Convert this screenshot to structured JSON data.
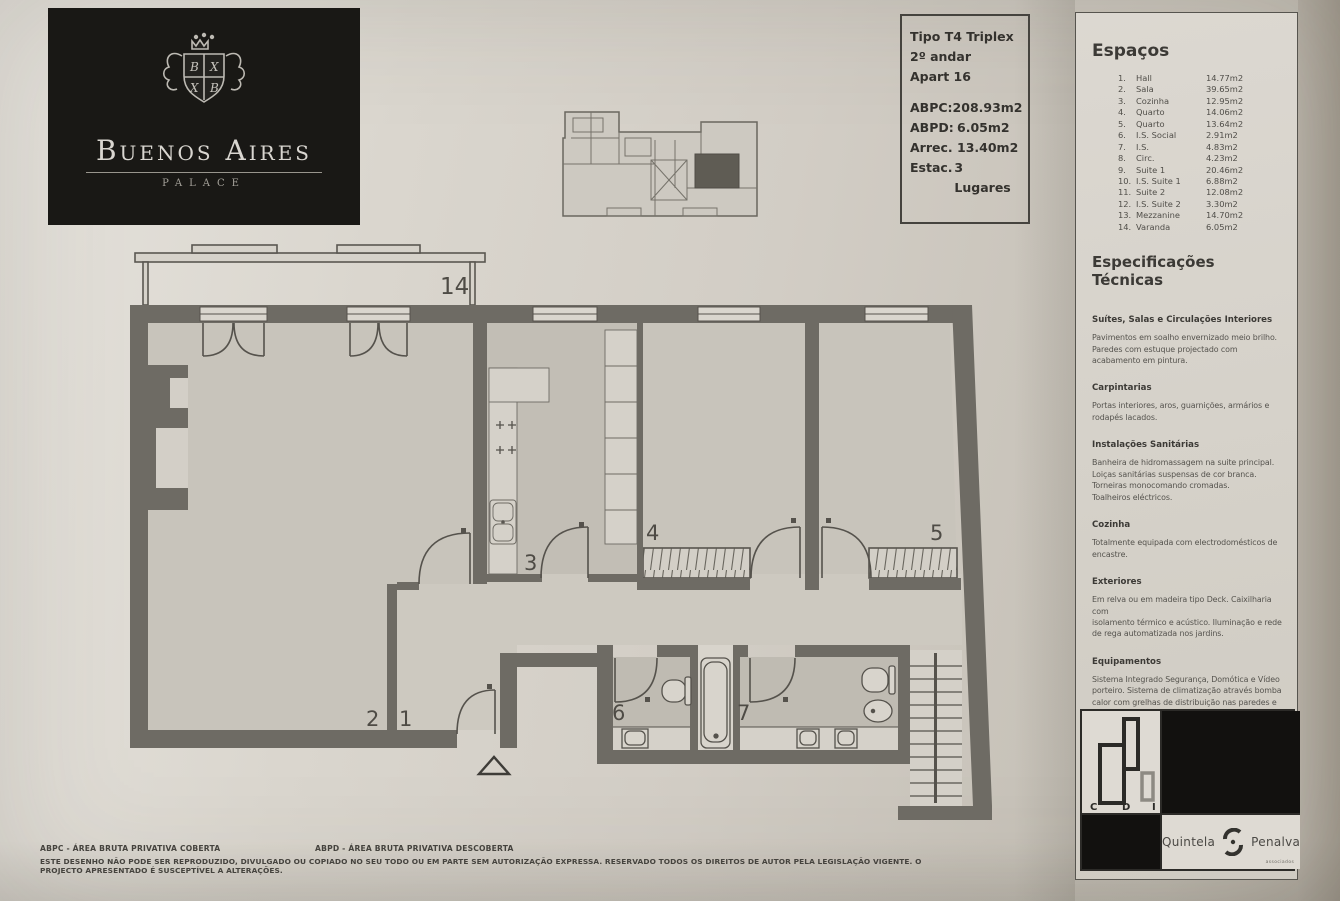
{
  "logo": {
    "title": "Buenos Aires",
    "subtitle": "PALACE",
    "crest": {
      "q1": "B",
      "q2": "X",
      "q3": "X",
      "q4": "B"
    }
  },
  "info_box": {
    "type": "Tipo T4 Triplex",
    "floor": "2º andar",
    "apartment": "Apart 16",
    "metrics": [
      {
        "label": "ABPC:",
        "value": "208.93m2"
      },
      {
        "label": "ABPD:",
        "value": "6.05m2"
      },
      {
        "label": "Arrec.",
        "value": "13.40m2"
      },
      {
        "label": "Estac.",
        "value": "3 Lugares"
      }
    ]
  },
  "sidebar": {
    "spaces_title": "Espaços",
    "spaces": [
      {
        "num": "1.",
        "name": "Hall",
        "area": "14.77m2"
      },
      {
        "num": "2.",
        "name": "Sala",
        "area": "39.65m2"
      },
      {
        "num": "3.",
        "name": "Cozinha",
        "area": "12.95m2"
      },
      {
        "num": "4.",
        "name": "Quarto",
        "area": "14.06m2"
      },
      {
        "num": "5.",
        "name": "Quarto",
        "area": "13.64m2"
      },
      {
        "num": "6.",
        "name": "I.S. Social",
        "area": "2.91m2"
      },
      {
        "num": "7.",
        "name": "I.S.",
        "area": "4.83m2"
      },
      {
        "num": "8.",
        "name": "Circ.",
        "area": "4.23m2"
      },
      {
        "num": "9.",
        "name": "Suite 1",
        "area": "20.46m2"
      },
      {
        "num": "10.",
        "name": "I.S. Suite 1",
        "area": "6.88m2"
      },
      {
        "num": "11.",
        "name": "Suite 2",
        "area": "12.08m2"
      },
      {
        "num": "12.",
        "name": "I.S. Suite 2",
        "area": "3.30m2"
      },
      {
        "num": "13.",
        "name": "Mezzanine",
        "area": "14.70m2"
      },
      {
        "num": "14.",
        "name": "Varanda",
        "area": "6.05m2"
      }
    ],
    "specs_title": "Especificações Técnicas",
    "specs": [
      {
        "heading": "Suítes, Salas e Circulações Interiores",
        "body": "Pavimentos em soalho envernizado meio brilho.\nParedes com estuque projectado com\nacabamento em pintura."
      },
      {
        "heading": "Carpintarias",
        "body": "Portas interiores, aros, guarnições, armários e\nrodapés lacados."
      },
      {
        "heading": "Instalações Sanitárias",
        "body": "Banheira de hidromassagem na suite principal.\nLoiças sanitárias suspensas de cor branca.\nTorneiras monocomando cromadas.\nToalheiros eléctricos."
      },
      {
        "heading": "Cozinha",
        "body": "Totalmente equipada com electrodomésticos de\nencastre."
      },
      {
        "heading": "Exteriores",
        "body": "Em relva ou em madeira tipo Deck. Caixilharia com\nisolamento térmico e acústico. Iluminação e rede\nde rega automatizada nos jardins."
      },
      {
        "heading": "Equipamentos",
        "body": "Sistema Integrado Segurança, Domótica e Vídeo\nporteiro. Sistema de climatização através bomba\ncalor com grelhas de distribuição nas paredes e\ntectos."
      }
    ]
  },
  "plan": {
    "labels": {
      "varanda": "14",
      "cozinha": "3",
      "quarto4": "4",
      "quarto5": "5",
      "sala": "2",
      "hall": "1",
      "is6": "6",
      "is7": "7"
    }
  },
  "branding": {
    "cdi_letters": [
      "C",
      "D",
      "I"
    ],
    "agency_name_1": "Quintela",
    "agency_name_2": "Penalva",
    "agency_sub": "associados"
  },
  "footer": {
    "legend_abpc": "ABPC - ÁREA BRUTA PRIVATIVA COBERTA",
    "legend_abpd": "ABPD - ÁREA BRUTA PRIVATIVA DESCOBERTA",
    "disclaimer": "ESTE DESENHO NÃO PODE SER REPRODUZIDO, DIVULGADO OU COPIADO NO SEU TODO OU EM PARTE SEM AUTORIZAÇÃO EXPRESSA. RESERVADO TODOS OS DIREITOS DE AUTOR PELA LEGISLAÇÃO VIGENTE. O PROJECTO APRESENTADO É SUSCEPTÍVEL A ALTERAÇÕES."
  },
  "colors": {
    "paper": "#d6d2ca",
    "wall": "#6e6b64",
    "ink": "#3f3d38",
    "logo_bg": "#191815"
  }
}
